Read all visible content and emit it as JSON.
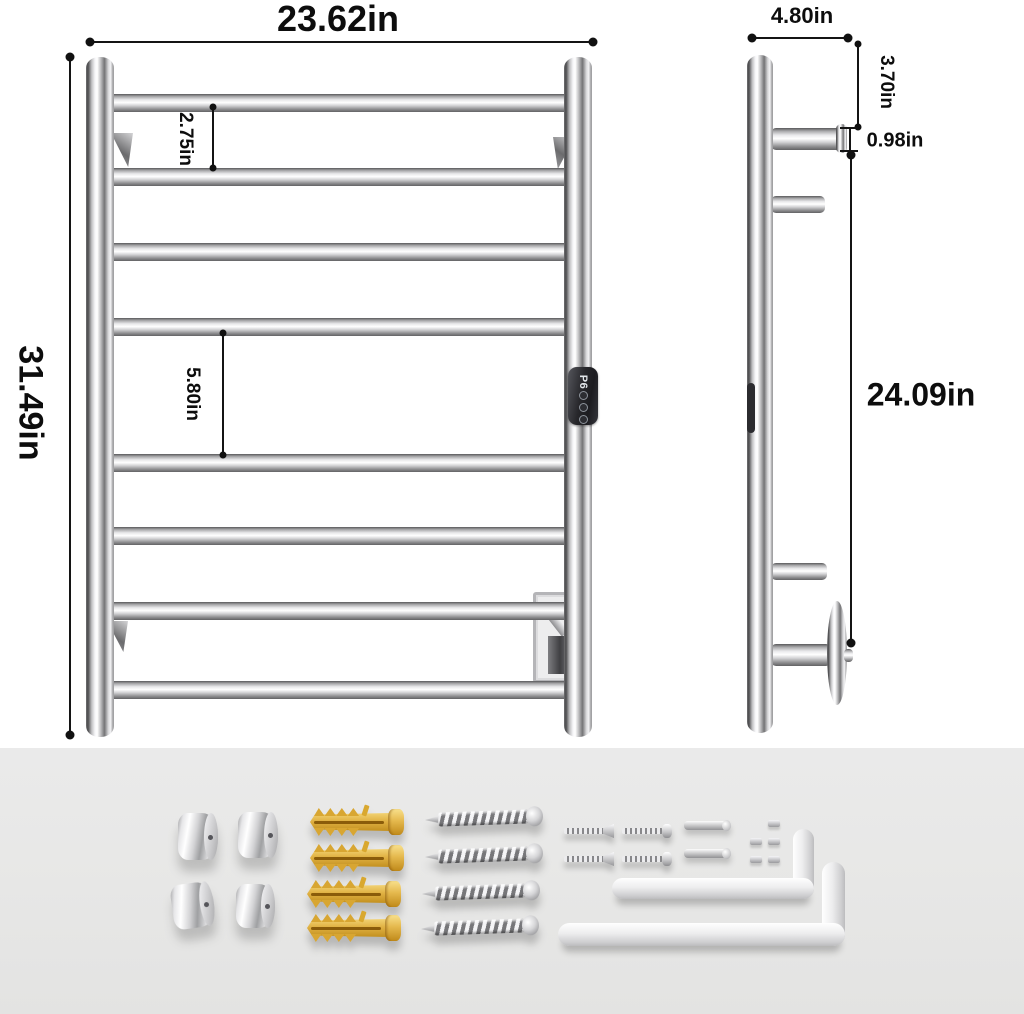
{
  "diagram": {
    "front_view": {
      "width_label": "23.62in",
      "height_label": "31.49in",
      "top_rung_gap_label": "2.75in",
      "middle_rung_gap_label": "5.80in",
      "rung_count": 8,
      "control_panel": {
        "display_text": "P6",
        "button_count": 3
      }
    },
    "side_view": {
      "depth_label": "4.80in",
      "top_to_bracket_label": "3.70in",
      "bar_diameter_label": "0.98in",
      "bracket_span_label": "24.09in"
    },
    "hardware_kit": {
      "chrome_mount_caps": 4,
      "plastic_wall_anchors": 4,
      "mounting_screws": 4,
      "flat_head_machine_screws": 2,
      "pan_head_machine_screws": 2,
      "connector_pins": 2,
      "grub_screws": 5,
      "allen_keys": 2
    },
    "colors": {
      "background": "#ffffff",
      "hardware_tray": "#e8e8e7",
      "dimension_ink": "#111111",
      "anchor_yellow": "#e9be55",
      "panel_dark": "#26262b"
    }
  }
}
